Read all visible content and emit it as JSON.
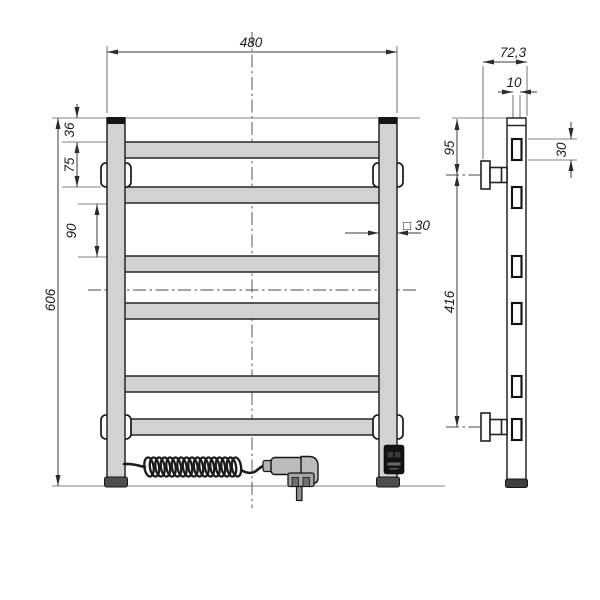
{
  "drawing": {
    "subject": "electric-towel-rail-two-view-dimension-drawing",
    "dimensions": {
      "overall_width": "480",
      "overall_height": "606",
      "top_to_first_rung": "36",
      "first_to_second_rung": "75",
      "rung_gap": "90",
      "tube_profile": "□ 30",
      "overall_depth": "72,3",
      "panel_thickness": "10",
      "top_to_upper_bracket": "95",
      "rung_height": "30",
      "bracket_spacing": "416"
    },
    "colors": {
      "line": "#262626",
      "tube_fill": "#d2d2d2",
      "side_profile_fill": "#ffffff",
      "cap_fill": "#161616",
      "foot_fill": "#4e4e4e",
      "module_fill": "#121212",
      "background": "#ffffff"
    }
  }
}
